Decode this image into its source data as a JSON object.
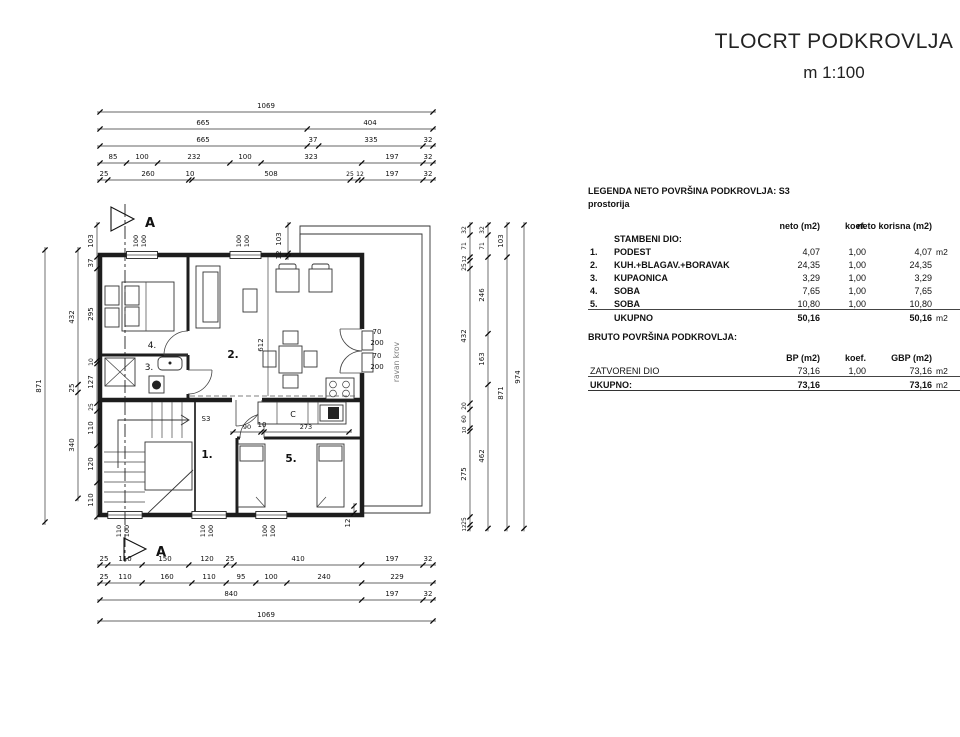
{
  "title": {
    "main": "TLOCRT PODKROVLJA",
    "scale": "m 1:100"
  },
  "dims": {
    "top": [
      [
        "1069"
      ],
      [
        "665",
        "404"
      ],
      [
        "665",
        "37",
        "335",
        "32"
      ],
      [
        "85",
        "100",
        "232",
        "100",
        "323",
        "197",
        "32"
      ],
      [
        "25",
        "260",
        "10",
        "508",
        "25",
        "12",
        "197",
        "32"
      ]
    ],
    "bottom": [
      [
        "25",
        "110",
        "150",
        "120",
        "25",
        "410",
        "197",
        "32"
      ],
      [
        "25",
        "110",
        "160",
        "110",
        "95",
        "100",
        "240",
        "229"
      ],
      [
        "840",
        "197",
        "32"
      ],
      [
        "1069"
      ]
    ],
    "left": [
      [
        "871"
      ],
      [
        "432",
        "25",
        "340"
      ],
      [
        "103",
        "37",
        "295",
        "10",
        "127",
        "25",
        "110",
        "120",
        "110"
      ]
    ],
    "right": [
      [
        "32",
        "71",
        "12",
        "25",
        "432",
        "20",
        "60",
        "10",
        "275",
        "25",
        "12"
      ],
      [
        "32",
        "71",
        "246",
        "163",
        "462"
      ],
      [
        "103",
        "871"
      ],
      [
        "974"
      ]
    ]
  },
  "annot": {
    "section": "A",
    "s3": "S3",
    "r1": "1.",
    "r2": "2.",
    "r3": "3.",
    "r4": "4.",
    "r5": "5.",
    "c": "C",
    "ravan_krov": "ravan krov",
    "v612": "612",
    "k90": "90",
    "k10": "10",
    "k273": "273",
    "door_w1": "70",
    "door_h1": "200",
    "door_w2": "70",
    "door_h2": "200",
    "wt1a": "100",
    "wt1b": "100",
    "wt2a": "100",
    "wt2b": "100",
    "wb1a": "110",
    "wb1b": "100",
    "wb2a": "110",
    "wb2b": "100",
    "wb3a": "100",
    "wb3b": "100",
    "tr_103": "103",
    "tr_12": "12",
    "br_12": "12"
  },
  "legend": {
    "title": "LEGENDA NETO POVRŠINA PODKROVLJA:  S3",
    "subtitle": "prostorija",
    "col_neto": "neto (m2)",
    "col_koef": "koef.",
    "col_korisna": "neto korisna (m2)",
    "section": "STAMBENI DIO:",
    "rows": [
      {
        "num": "1.",
        "name": "PODEST",
        "neto": "4,07",
        "koef": "1,00",
        "korisna": "4,07",
        "unit": "m2"
      },
      {
        "num": "2.",
        "name": "KUH.+BLAGAV.+BORAVAK",
        "neto": "24,35",
        "koef": "1,00",
        "korisna": "24,35",
        "unit": ""
      },
      {
        "num": "3.",
        "name": "KUPAONICA",
        "neto": "3,29",
        "koef": "1,00",
        "korisna": "3,29",
        "unit": ""
      },
      {
        "num": "4.",
        "name": "SOBA",
        "neto": "7,65",
        "koef": "1,00",
        "korisna": "7,65",
        "unit": ""
      },
      {
        "num": "5.",
        "name": "SOBA",
        "neto": "10,80",
        "koef": "1,00",
        "korisna": "10,80",
        "unit": ""
      }
    ],
    "total_label": "UKUPNO",
    "total_neto": "50,16",
    "total_korisna": "50,16",
    "total_unit": "m2"
  },
  "bruto": {
    "title": "BRUTO POVRŠINA  PODKROVLJA:",
    "col_bp": "BP (m2)",
    "col_koef": "koef.",
    "col_gbp": "GBP (m2)",
    "row": {
      "name": "ZATVORENI DIO",
      "bp": "73,16",
      "koef": "1,00",
      "gbp": "73,16",
      "unit": "m2"
    },
    "total_label": "UKUPNO:",
    "total_bp": "73,16",
    "total_gbp": "73,16",
    "total_unit": "m2"
  }
}
